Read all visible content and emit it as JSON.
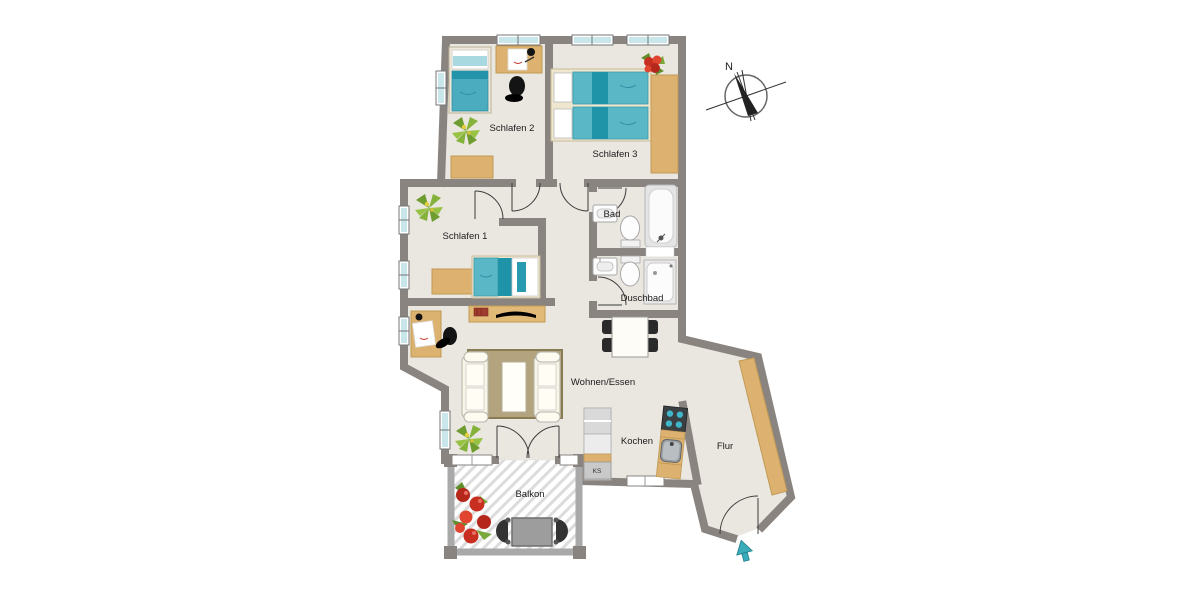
{
  "app": {
    "type": "floor-plan",
    "description": "Apartment floor plan drawing with balcony, three bedrooms, two baths and compass rose"
  },
  "rooms": {
    "schlafen1": "Schlafen 1",
    "schlafen2": "Schlafen 2",
    "schlafen3": "Schlafen 3",
    "bad": "Bad",
    "duschbad": "Duschbad",
    "wohnen_essen": "Wohnen/Essen",
    "kochen": "Kochen",
    "flur": "Flur",
    "balkon": "Balkon"
  },
  "kitchen": {
    "fridge": "KS"
  },
  "compass": {
    "north": "N"
  },
  "colors": {
    "wall": "#8a8480",
    "balcony_wall": "#a9a9a9",
    "floor": "#eae6e0",
    "wood": "#ddb271",
    "teal": "#4aacbe",
    "teal_dark": "#1f93a8",
    "window": "#c9e6ea",
    "rug": "#b3a37f",
    "plant_green": "#85b23a",
    "flower_red": "#c92f21",
    "arrow_teal": "#3aabb8"
  }
}
